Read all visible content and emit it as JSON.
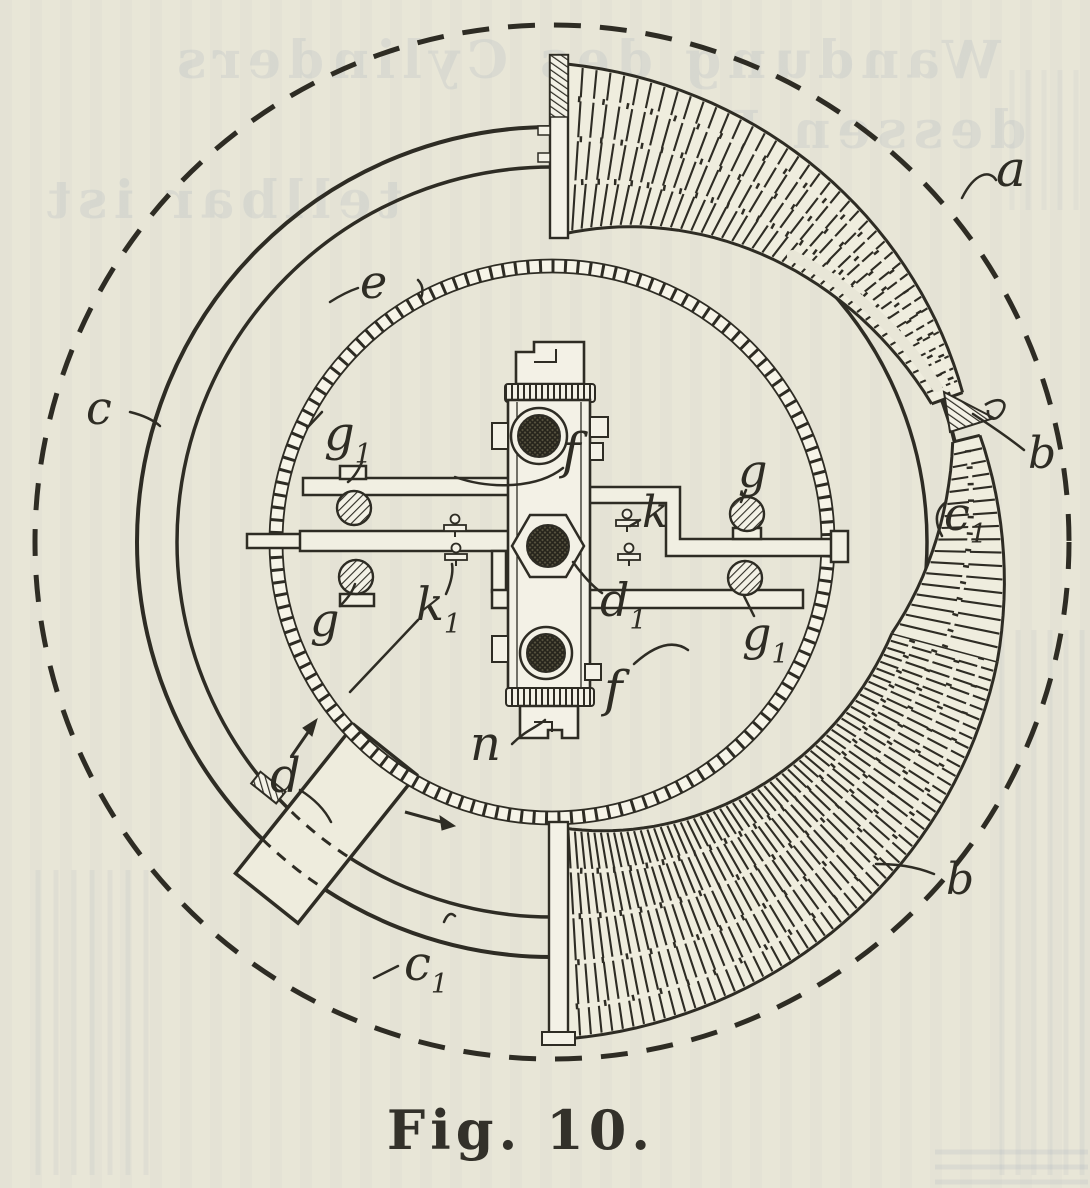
{
  "colors": {
    "paper": "#e8e6d7",
    "ink": "#2e2c24",
    "ghost_bleed": "#8d99b3"
  },
  "caption": {
    "text": "Fig. 10."
  },
  "labels": {
    "a": {
      "main": "a"
    },
    "b_tip": {
      "main": "b"
    },
    "b_lower": {
      "main": "b"
    },
    "c": {
      "main": "c"
    },
    "c1_right": {
      "main": "c",
      "sub": "1"
    },
    "c1_bottom": {
      "main": "c",
      "sub": "1"
    },
    "d": {
      "main": "d"
    },
    "d1": {
      "main": "d",
      "sub": "1"
    },
    "e": {
      "main": "e"
    },
    "f_upper": {
      "main": "f"
    },
    "f_lower": {
      "main": "f"
    },
    "g1_top_left": {
      "main": "g",
      "sub": "1"
    },
    "g_top_right": {
      "main": "g"
    },
    "g_bottom_left": {
      "main": "g"
    },
    "g1_bottom_right": {
      "main": "g",
      "sub": "1"
    },
    "k": {
      "main": "k"
    },
    "k1": {
      "main": "k",
      "sub": "1"
    },
    "n": {
      "main": "n"
    }
  },
  "bleedthrough": {
    "lines": [
      "Wandung des Cylinders",
      "dessen Reib",
      "tellbar ist"
    ]
  }
}
